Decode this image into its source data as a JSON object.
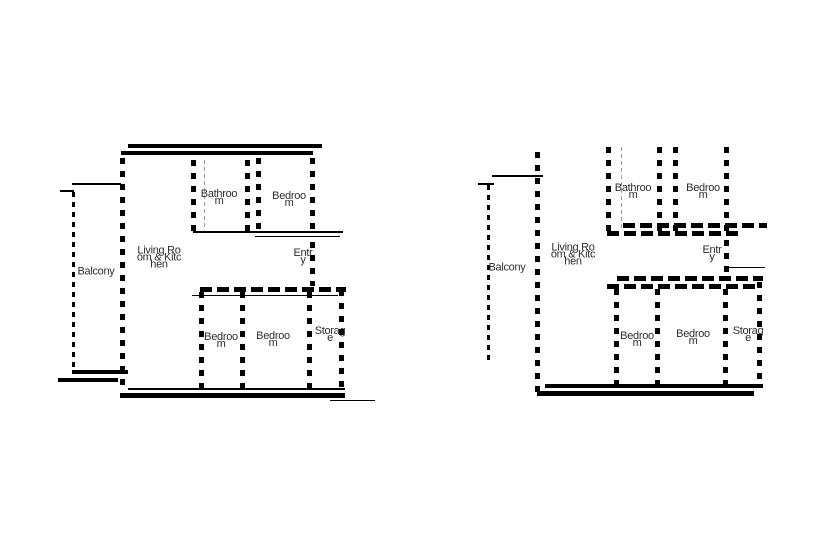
{
  "colors": {
    "background": "#ffffff",
    "wall": "#000000",
    "text": "#1a1a1a"
  },
  "plans": [
    {
      "id": "left",
      "rooms": {
        "balcony": "Balcony",
        "living": "Living Room & Kitchen",
        "bathroom": "Bathroom",
        "bedroom_top": "Bedroom",
        "entry": "Entry",
        "bedroom_1": "Bedroom",
        "bedroom_2": "Bedroom",
        "storage": "Storage"
      }
    },
    {
      "id": "right",
      "rooms": {
        "balcony": "Balcony",
        "living": "Living Room & Kitchen",
        "bathroom": "Bathroom",
        "bedroom_top": "Bedroom",
        "entry": "Entry",
        "bedroom_1": "Bedroom",
        "bedroom_2": "Bedroom",
        "storage": "Storage"
      }
    }
  ]
}
